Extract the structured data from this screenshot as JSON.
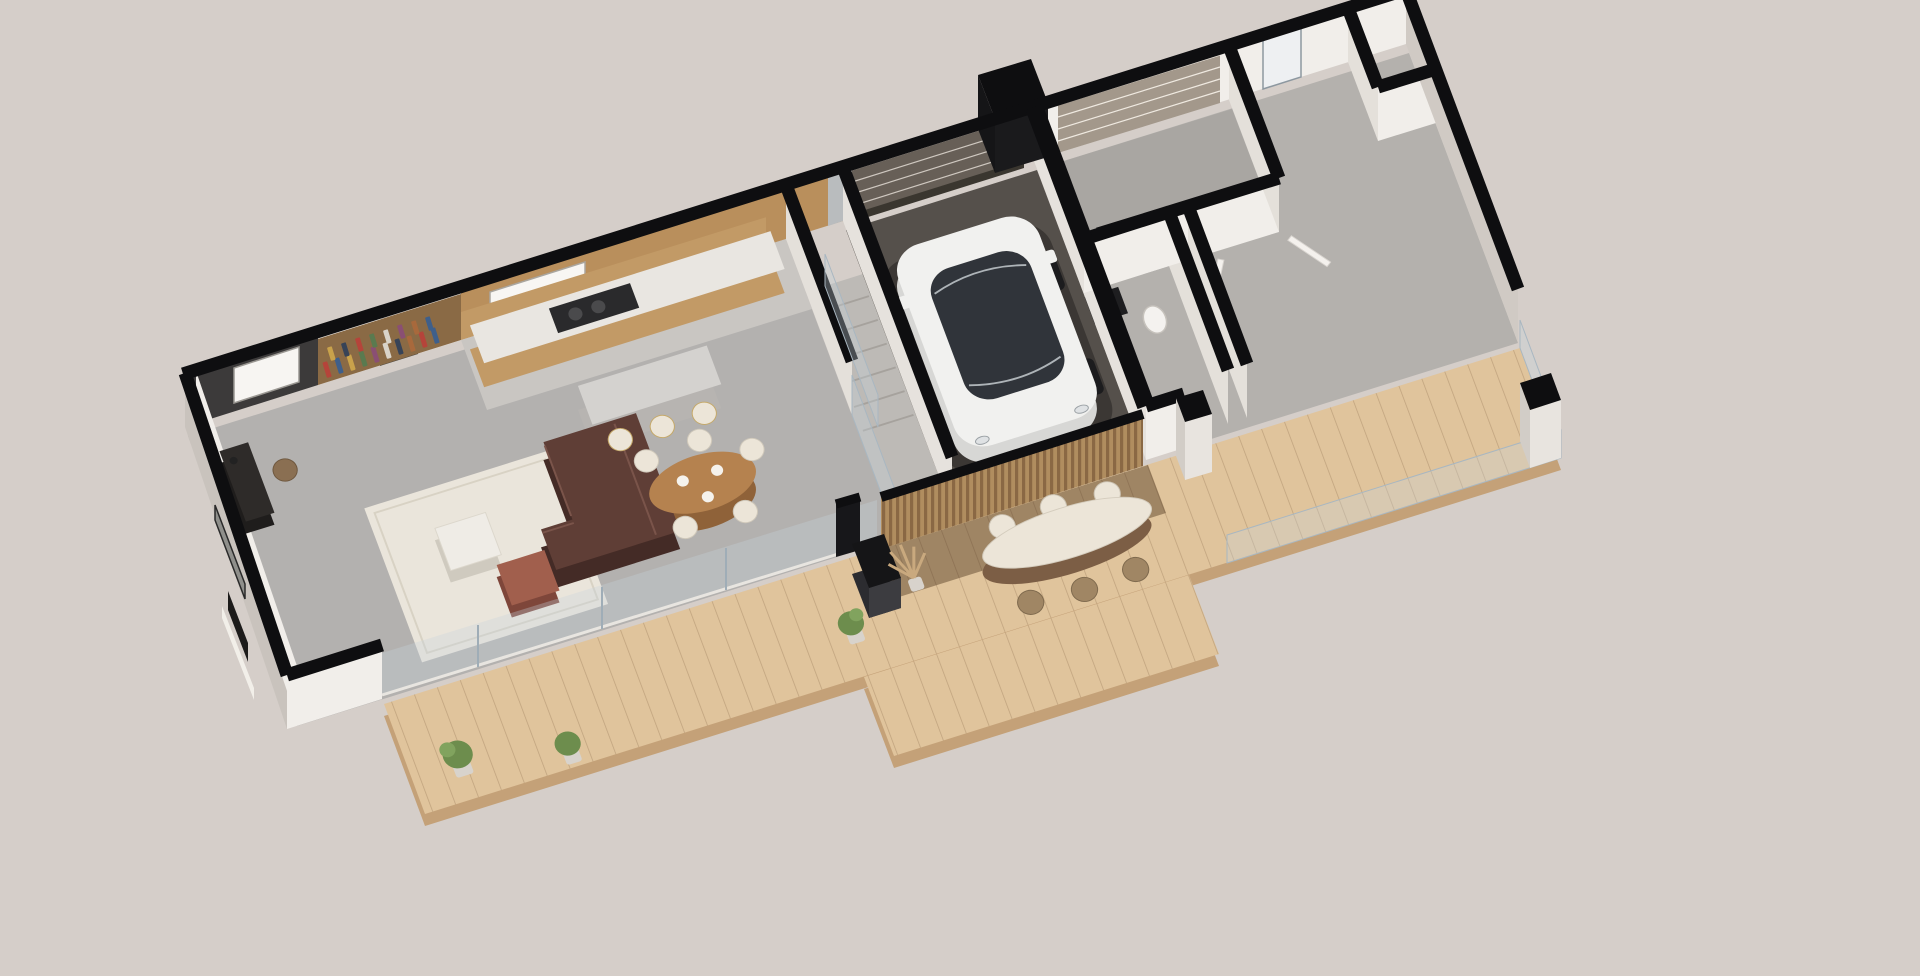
{
  "scene": {
    "type": "isometric-3d-floor-plan-render",
    "description": "Axonometric cutaway render of a single-storey duplex house: furnished left unit (living room, office nook, kitchen, garage with white electric car), unfurnished right unit (garage, hallway, empty rooms), continuous front timber deck with outdoor dining set and step platform.",
    "background": "#d5cec9",
    "palette": {
      "black": "#0e0e10",
      "wallWhite": "#f1eeea",
      "wallShade": "#e4e0da",
      "wallDark": "#3c3a3a",
      "concrete": "#c9c3bd",
      "concreteLight": "#d0cac4",
      "floorGrey": "#b3b1af",
      "floorGreyRight": "#b4b1ad",
      "floorGreyGarage2": "#a9a6a2",
      "stairGrey": "#bdbab6",
      "garageFloor": "#55504b",
      "bathFloor": "#d7d2cb",
      "deckWood": "#e0c49c",
      "deckShadow": "#7c5e45",
      "deckEdge": "#c4a178",
      "slatWood": "#b08d5f",
      "glass": "rgba(198,212,222,0.32)",
      "glassEdge": "#a9b7c1",
      "kitchenWood": "#c29a66",
      "kitchenWoodDark": "#b98f5c",
      "counter": "#e9e6e1",
      "cooktop": "#2a2a2c",
      "island": "#d4d2cf",
      "islandSide": "#b7b4b1",
      "sofa": "#5f3e36",
      "sofaDark": "#442b26",
      "rug": "#eae5db",
      "ottoman": "#a15f4d",
      "ottomanDark": "#7e463a",
      "tableWood": "#b5824f",
      "tableWoodDark": "#8f6239",
      "chairCream": "#ece5d8",
      "chairRattan": "#a08664",
      "marble": "#efece6",
      "deskDark": "#2e2b29",
      "artGrey": "#8f8f8b",
      "plantGreen": "#6d8d4d",
      "potGrey": "#d8d3cc",
      "pampas": "#c9a97e",
      "stainless": "#b9bcbe",
      "garageDoor": "#675f57",
      "garageDoorLight": "#a3988b",
      "doorDark": "#4a463f",
      "carBody": "#f1f1ef",
      "carSide": "#d7d7d5",
      "carGlass": "#30343a",
      "fireplaceDark": "#1c1b1a",
      "bookshelfWood": "#8a6a45"
    },
    "units": {
      "left_unit": {
        "rooms": [
          "office-nook",
          "living-room",
          "kitchen",
          "staircase",
          "garage",
          "bathroom"
        ],
        "furniture": [
          "bookshelf",
          "desk",
          "desk-chair",
          "wall-artwork",
          "fireplace-bench",
          "corner-sofa",
          "rug",
          "marble-coffee-table",
          "leather-ottoman",
          "kitchen-cabinets",
          "cooktop",
          "kitchen-island",
          "bar-stool",
          "bar-stool",
          "bar-stool",
          "dining-table",
          "dining-chairs",
          "white-electric-car",
          "toilet",
          "vanity"
        ]
      },
      "right_unit": {
        "rooms": [
          "garage",
          "hallway",
          "storage-rooms",
          "main-room",
          "rear-nook"
        ],
        "furniture": []
      }
    },
    "exterior": {
      "features": [
        "timber-deck",
        "deck-step-platform",
        "timber-slat-wall",
        "outdoor-dining-table",
        "outdoor-chairs",
        "outdoor-fireplace",
        "potted-plant",
        "pampas-grass",
        "glass-balustrade",
        "concrete-pillar",
        "rear-entry-volume",
        "garage-door",
        "garage-door"
      ]
    }
  }
}
